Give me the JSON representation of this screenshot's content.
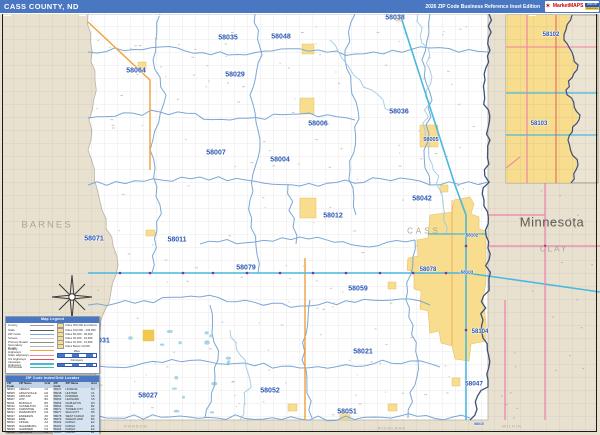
{
  "header": {
    "title": "CASS COUNTY, ND",
    "edition": "2026 ZIP Code Business Reference Inset Edition",
    "logo": {
      "star": "✶",
      "brand": "MarketMAPS",
      "badge_top": "2026 ZIP",
      "badge_bottom": "Reference"
    }
  },
  "map": {
    "state_label": "Minnesota",
    "county_labels": [
      {
        "t": "BARNES",
        "x": 47,
        "y": 225,
        "s": 9.5,
        "ls": 2,
        "cls": ""
      },
      {
        "t": "CASS",
        "x": 424,
        "y": 231,
        "s": 8,
        "ls": 3,
        "cls": ""
      },
      {
        "t": "Minnesota",
        "x": 552,
        "y": 222,
        "s": 13,
        "ls": 0.5,
        "cls": "state"
      },
      {
        "t": "CLAY",
        "x": 554,
        "y": 249,
        "s": 8,
        "ls": 2,
        "cls": ""
      },
      {
        "t": "RANSOM",
        "x": 136,
        "y": 426,
        "s": 4,
        "ls": 1,
        "cls": ""
      },
      {
        "t": "RICHLAND",
        "x": 392,
        "y": 428,
        "s": 4,
        "ls": 1,
        "cls": ""
      },
      {
        "t": "WILKIN",
        "x": 512,
        "y": 426,
        "s": 4,
        "ls": 1,
        "cls": ""
      }
    ],
    "zip_labels": [
      {
        "t": "58035",
        "x": 228,
        "y": 38,
        "s": 7
      },
      {
        "t": "58048",
        "x": 281,
        "y": 37,
        "s": 7
      },
      {
        "t": "58038",
        "x": 395,
        "y": 18,
        "s": 7
      },
      {
        "t": "58064",
        "x": 136,
        "y": 71,
        "s": 7
      },
      {
        "t": "58029",
        "x": 235,
        "y": 75,
        "s": 7
      },
      {
        "t": "58006",
        "x": 318,
        "y": 124,
        "s": 7
      },
      {
        "t": "58036",
        "x": 399,
        "y": 112,
        "s": 7
      },
      {
        "t": "58007",
        "x": 216,
        "y": 153,
        "s": 7
      },
      {
        "t": "58004",
        "x": 280,
        "y": 160,
        "s": 7
      },
      {
        "t": "58005",
        "x": 431,
        "y": 140,
        "s": 5.5
      },
      {
        "t": "58012",
        "x": 333,
        "y": 216,
        "s": 7
      },
      {
        "t": "58042",
        "x": 422,
        "y": 199,
        "s": 7
      },
      {
        "t": "58071",
        "x": 94,
        "y": 239,
        "s": 7
      },
      {
        "t": "58011",
        "x": 177,
        "y": 240,
        "s": 7
      },
      {
        "t": "58079",
        "x": 246,
        "y": 268,
        "s": 7
      },
      {
        "t": "58078",
        "x": 428,
        "y": 270,
        "s": 6
      },
      {
        "t": "58102",
        "x": 472,
        "y": 235,
        "s": 4.5
      },
      {
        "t": "58103",
        "x": 467,
        "y": 272,
        "s": 4.5
      },
      {
        "t": "58059",
        "x": 358,
        "y": 289,
        "s": 7
      },
      {
        "t": "58031",
        "x": 100,
        "y": 341,
        "s": 7
      },
      {
        "t": "58021",
        "x": 363,
        "y": 352,
        "s": 7
      },
      {
        "t": "58104",
        "x": 480,
        "y": 332,
        "s": 6
      },
      {
        "t": "58052",
        "x": 270,
        "y": 391,
        "s": 7
      },
      {
        "t": "58027",
        "x": 148,
        "y": 396,
        "s": 7
      },
      {
        "t": "58051",
        "x": 347,
        "y": 412,
        "s": 7
      },
      {
        "t": "58047",
        "x": 474,
        "y": 384,
        "s": 6.5
      },
      {
        "t": "58015",
        "x": 479,
        "y": 424,
        "s": 3.5
      },
      {
        "t": "58102",
        "x": 551,
        "y": 35,
        "s": 6
      },
      {
        "t": "58103",
        "x": 539,
        "y": 124,
        "s": 6
      }
    ]
  },
  "legend": {
    "title": "Map Legend",
    "line_items": [
      {
        "label": "County",
        "color": "#9a9a9a",
        "w": 1.6
      },
      {
        "label": "State",
        "color": "#5a5a5a",
        "w": 1.6
      },
      {
        "label": "ZIP Code",
        "color": "#7aa7d6",
        "w": 1.4
      },
      {
        "label": "Streets",
        "color": "#c8c8c8",
        "w": 1
      },
      {
        "label": "Primary Roads",
        "color": "#8a8a8a",
        "w": 1.2
      },
      {
        "label": "Secondary Roads",
        "color": "#b5b5b5",
        "w": 1
      },
      {
        "label": "County Highways",
        "color": "#f0a03c",
        "w": 1.8
      },
      {
        "label": "State Highways",
        "color": "#f07fa8",
        "w": 1.8
      },
      {
        "label": "US Highways",
        "color": "#e05050",
        "w": 1.8
      },
      {
        "label": "Interstate Highways",
        "color": "#49b8e0",
        "w": 2
      },
      {
        "label": "Toll Roads",
        "color": "#4cc08a",
        "w": 1.8
      }
    ],
    "city_items": [
      "Cities 250,000 and Above",
      "Cities 100,000 - 249,999",
      "Cities 50,000 - 99,999",
      "Cities 25,000 - 49,999",
      "Cities 10,000 - 24,999",
      "Cities Below 10,000"
    ],
    "scale_labels": [
      "Miles",
      "Kilometers"
    ]
  },
  "index": {
    "title": "ZIP Code Index/Grid Locator",
    "columns": [
      "ZIP Code",
      "ZIP Name",
      "Grid"
    ],
    "left_rows": [
      [
        "58004",
        "AMENIA",
        "C2"
      ],
      [
        "58005",
        "ARGUSVILLE",
        "D2"
      ],
      [
        "58006",
        "ARTHUR",
        "C2"
      ],
      [
        "58007",
        "AYR",
        "B2"
      ],
      [
        "58011",
        "BUFFALO",
        "B3"
      ],
      [
        "58012",
        "CASSELTON",
        "C3"
      ],
      [
        "58015",
        "CHRISTINE",
        "D5"
      ],
      [
        "58021",
        "DAVENPORT",
        "D4"
      ],
      [
        "58027",
        "ENDERLIN",
        "A5"
      ],
      [
        "58029",
        "ERIE",
        "B2"
      ],
      [
        "58031",
        "FINGAL",
        "A4"
      ],
      [
        "58035",
        "GALESBURG",
        "C1"
      ],
      [
        "58036",
        "GARDNER",
        "D1"
      ],
      [
        "58038",
        "GRANDIN",
        "D1"
      ],
      [
        "58042",
        "HARWOOD",
        "D2"
      ]
    ],
    "right_rows": [
      [
        "58047",
        "HORACE",
        "D4"
      ],
      [
        "58048",
        "HUNTER",
        "C1"
      ],
      [
        "58051",
        "KINDRED",
        "C5"
      ],
      [
        "58052",
        "LEONARD",
        "C5"
      ],
      [
        "58059",
        "MAPLETON",
        "D3"
      ],
      [
        "58064",
        "PAGE",
        "B2"
      ],
      [
        "58071",
        "TOWER CITY",
        "A3"
      ],
      [
        "58077",
        "WALCOTT",
        "D5"
      ],
      [
        "58078",
        "WEST FARGO",
        "D3"
      ],
      [
        "58079",
        "WHEATLAND",
        "B3"
      ],
      [
        "58102",
        "FARGO",
        "E2"
      ],
      [
        "58103",
        "FARGO",
        "E3"
      ],
      [
        "58104",
        "FARGO",
        "E3"
      ],
      [
        "58105",
        "FARGO",
        "E2"
      ],
      [
        "58106",
        "FARGO",
        "E2"
      ]
    ]
  }
}
